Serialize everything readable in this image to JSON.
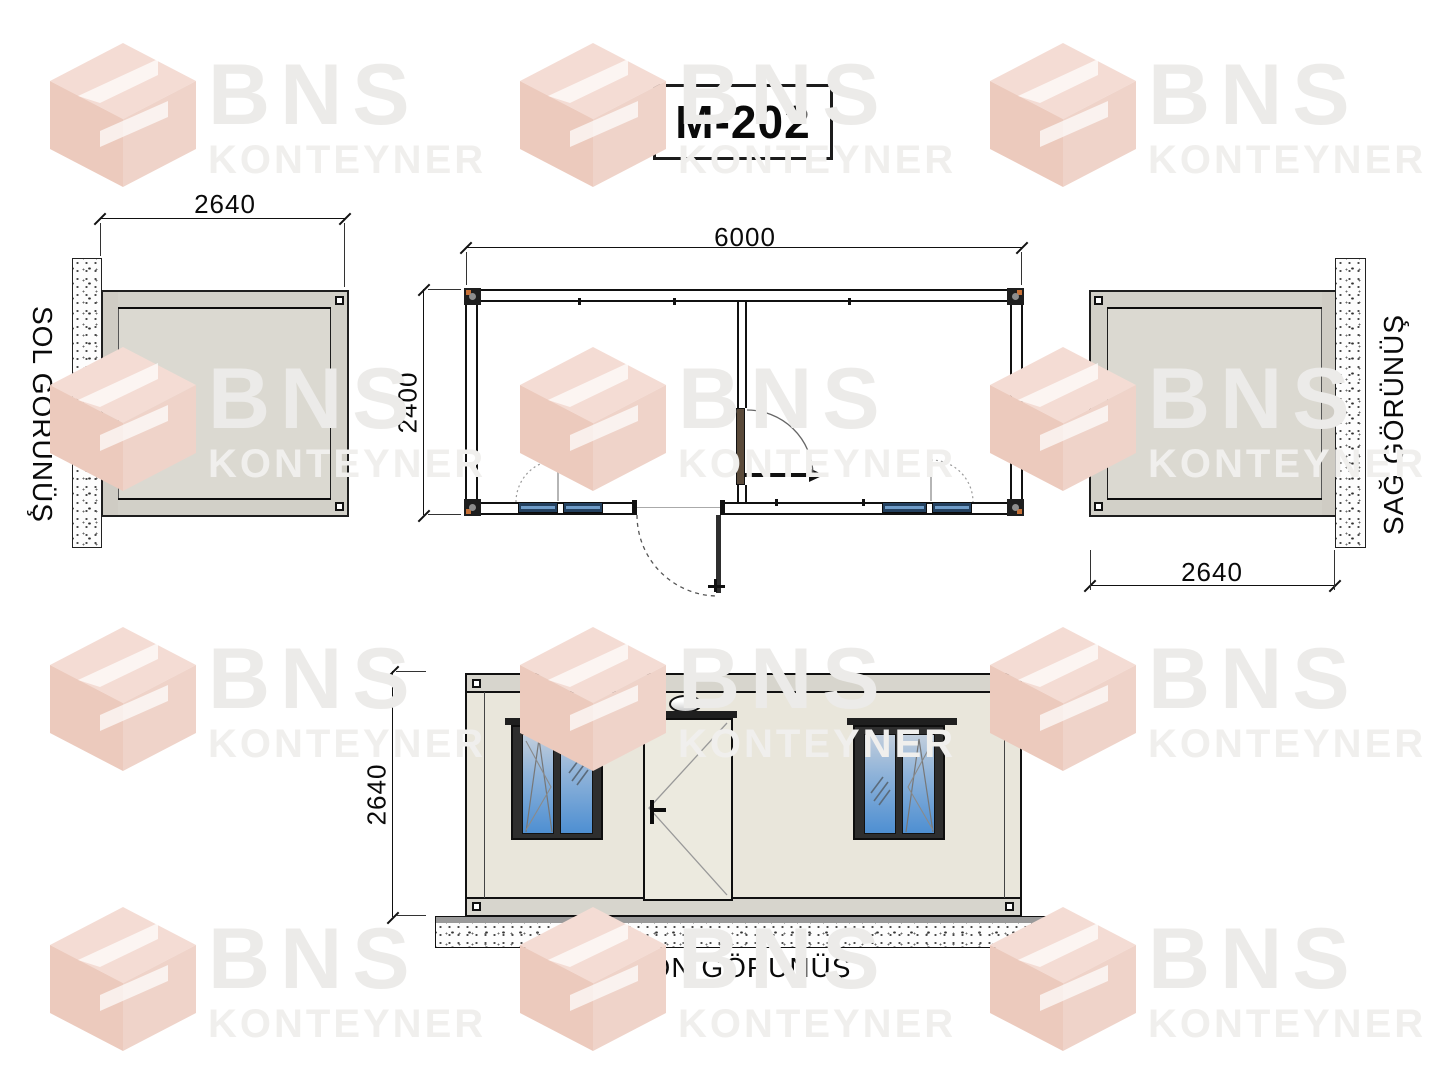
{
  "title": "M-202",
  "brand": {
    "name": "BNS",
    "subname": "KONTEYNER"
  },
  "views": {
    "left": {
      "label": "SOL GÖRÜNÜŞ",
      "dim_width": "2640"
    },
    "plan": {
      "dim_width": "6000",
      "dim_depth": "2400"
    },
    "right": {
      "label": "SAĞ GÖRÜNÜŞ",
      "dim_width": "2640"
    },
    "front": {
      "label": "ÖN GÖRÜNÜŞ",
      "dim_height": "2640"
    }
  },
  "colors": {
    "wall": "#E9E6DB",
    "band": "#D7D5CD",
    "sideBody": "#DBD9D1",
    "sideBand": "#D2D0C8",
    "leftCol": "#CFCCC4",
    "glassTop": "#C2CEDC",
    "glassMid": "#8FB3D9",
    "glassBot": "#4E8FD2",
    "cornerOrange": "#C77137",
    "doorLeafBrown": "#5A4A3A",
    "doorLeaf": "#ECEADF",
    "wmText": "#ECEBE9",
    "wmText2": "#F0EFED",
    "wmLogoA": "#F4DCD4",
    "wmLogoB": "#ECCabd",
    "wmLogoC": "#EFD3C9"
  }
}
